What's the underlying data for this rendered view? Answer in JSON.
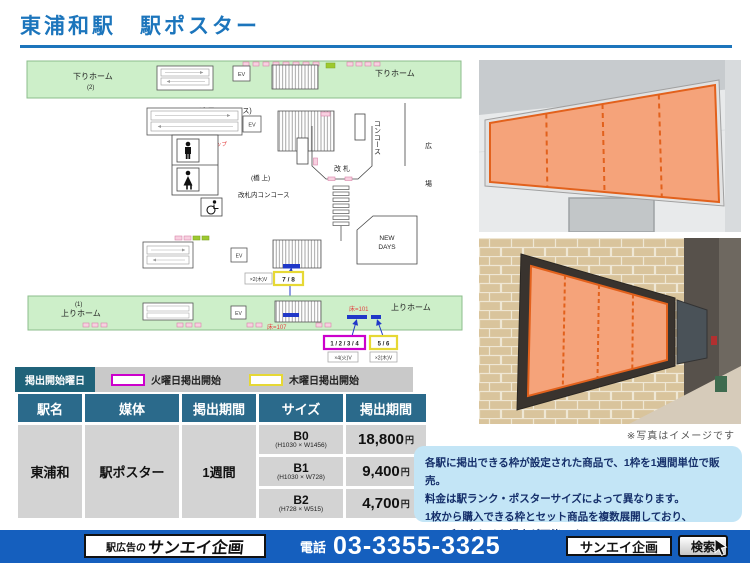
{
  "title": "東浦和駅　駅ポスター",
  "map": {
    "platform_down": "下りホーム",
    "platform_down_no": "(2)",
    "platform_up": "上りホーム",
    "platform_up_no": "(1)",
    "main_concourse": "(本屋コンコース)",
    "bridge": "(橋 上)",
    "gate_concourse": "改札内コンコース",
    "gate": "改 札",
    "concourse": "コンコース",
    "plaza_1": "広",
    "plaza_2": "場",
    "station_map_label": "駅マップ",
    "ev": "EV",
    "newdays_1": "NEW",
    "newdays_2": "DAYS",
    "frame_78": "7 / 8",
    "frame_1234": "1 / 2 / 3 / 4",
    "frame_56": "5 / 6",
    "note_thu_a": "×2(木)V",
    "note_tue": "×4(火)V",
    "note_thu_b": "×2(木)V",
    "floor_107": "床=107",
    "floor_101": "床=101"
  },
  "legend": {
    "title": "掲出開始曜日",
    "tuesday": "火曜日掲出開始",
    "thursday": "木曜日掲出開始"
  },
  "table": {
    "headers": [
      "駅名",
      "媒体",
      "掲出期間",
      "サイズ",
      "掲出期間"
    ],
    "station": "東浦和",
    "media": "駅ポスター",
    "period": "1週間",
    "yen": "円",
    "rows": [
      {
        "size": "B0",
        "dims": "(H1030 × W1456)",
        "price": "18,800"
      },
      {
        "size": "B1",
        "dims": "(H1030 × W728)",
        "price": "9,400"
      },
      {
        "size": "B2",
        "dims": "(H728 × W515)",
        "price": "4,700"
      }
    ]
  },
  "photos": {
    "caption": "※写真はイメージです"
  },
  "info": {
    "line1": "各駅に掲出できる枠が設定された商品で、1枠を1週間単位で販売。",
    "line2": "料金は駅ランク・ポスターサイズによって異なります。",
    "line3": "1枚から購入できる枠とセット商品を複数展開しており、",
    "line4": "ニーズに合わせた掲出が可能です。"
  },
  "footer": {
    "logo_prefix": "駅広告の",
    "logo_name": "サンエイ企画",
    "phone_label": "電話",
    "phone_number": "03-3355-3325",
    "search_value": "サンエイ企画",
    "search_button": "検索"
  },
  "colors": {
    "accent_blue": "#1C75BC",
    "table_header_teal": "#2B6A8B",
    "footer_blue": "#155FBE",
    "legend_magenta": "#CC00CC",
    "legend_yellow": "#E6D835",
    "poster_orange": "#F5A37A",
    "platform_green": "#CDEFC9",
    "annotation_blue": "#2038C8",
    "annotation_red": "#E34040"
  }
}
